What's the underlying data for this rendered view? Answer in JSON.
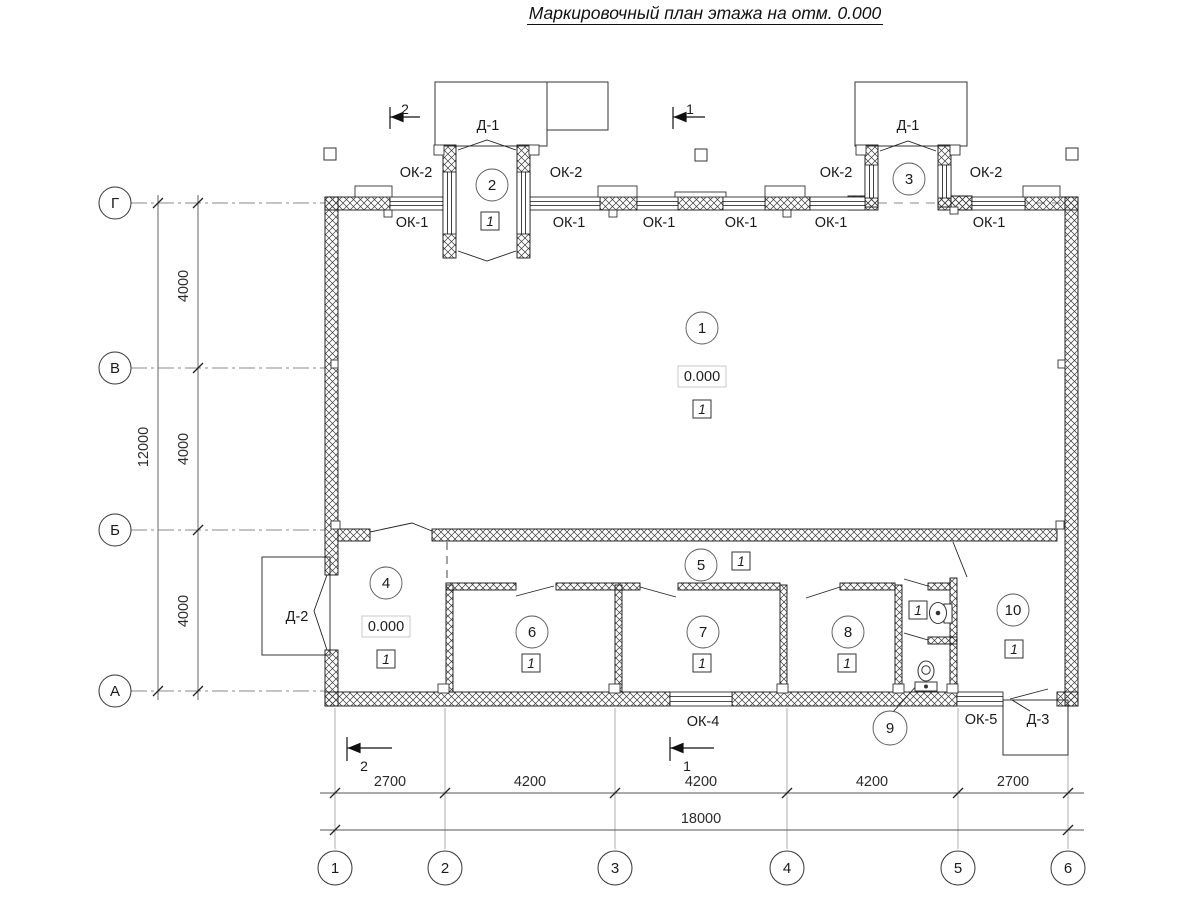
{
  "title": "Маркировочный план этажа на отм. 0.000",
  "axes": {
    "vertical": [
      "Г",
      "В",
      "Б",
      "А"
    ],
    "horizontal": [
      "1",
      "2",
      "3",
      "4",
      "5",
      "6"
    ]
  },
  "dimensions": {
    "vertical_segments": [
      "4000",
      "4000",
      "4000"
    ],
    "vertical_total": "12000",
    "horizontal_segments": [
      "2700",
      "4200",
      "4200",
      "4200",
      "2700"
    ],
    "horizontal_total": "18000"
  },
  "section_marks": {
    "top_left": "2",
    "top_center": "1",
    "bottom_left": "2",
    "bottom_center": "1"
  },
  "rooms": [
    "1",
    "2",
    "3",
    "4",
    "5",
    "6",
    "7",
    "8",
    "9",
    "10"
  ],
  "floor_type_mark": "1",
  "elevation_mark": "0.000",
  "openings": {
    "window_ok1": "ОК-1",
    "window_ok2": "ОК-2",
    "window_ok4": "ОК-4",
    "window_ok5": "ОК-5",
    "door_d1": "Д-1",
    "door_d2": "Д-2",
    "door_d3": "Д-3"
  }
}
